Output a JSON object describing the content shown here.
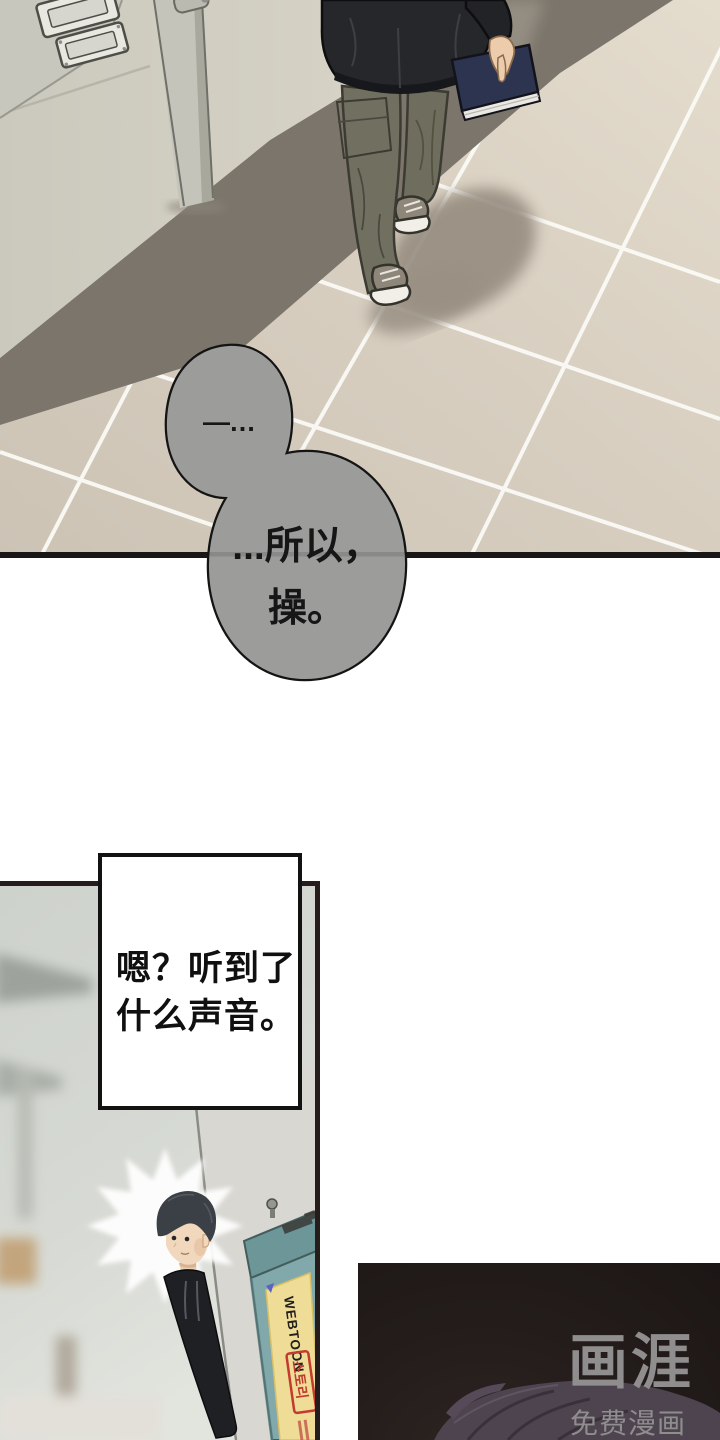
{
  "page": {
    "width": 720,
    "height": 1440,
    "background": "#ffffff"
  },
  "panel_hallway": {
    "bubbles": {
      "small_text": "—…",
      "large_line1": "...所以，",
      "large_line2": "操。",
      "fill": "#9c9c9a",
      "outline": "#141414"
    },
    "floor_tile_color": "#d7cec0",
    "wall_color": "#d2cfc3",
    "book_color": "#2c3450"
  },
  "caption_box": {
    "line1": "嗯？听到了",
    "line2": "什么声音。",
    "background": "#ffffff",
    "border": "#121212"
  },
  "panel_peek": {
    "poster": {
      "title": "WEBTOON",
      "subtitle": "스토리",
      "board_color": "#81a8aa",
      "poster_color": "#eedc97",
      "accent_red": "#c23b2e"
    }
  },
  "panel_dark": {
    "watermark_logo": "画涯",
    "watermark_tagline": "免费漫画",
    "watermark_color": "#8f8d8e",
    "background": "#221b1a"
  }
}
